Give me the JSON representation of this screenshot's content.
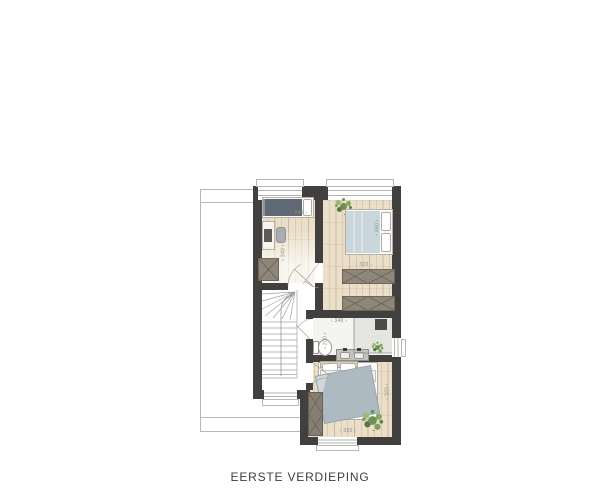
{
  "title": "EERSTE VERDIEPING",
  "plan": {
    "dimensions": {
      "bedroom_left": {
        "width": "‹ 240 ›",
        "depth": "‹ 340 ›"
      },
      "bedroom_right": {
        "width": "‹ 320 ›",
        "depth": "‹ 460 ›"
      },
      "bathroom": {
        "width": "‹ 340 ›",
        "depth": "‹ 200 ›"
      },
      "bedroom_master": {
        "width": "‹ 350 ›",
        "depth": "‹ 320 ›"
      }
    },
    "colors": {
      "wall": "#42403e",
      "wood_floor": "#ebdfc9",
      "bed_slate": "#5f6975",
      "bed_blue": "#c9d6dc",
      "duvet": "#adbac2",
      "wardrobe": "#8e8678",
      "plant": "#6d9150",
      "dimension_text": "#8f8d85",
      "contour_line": "#b9b7b1"
    }
  }
}
